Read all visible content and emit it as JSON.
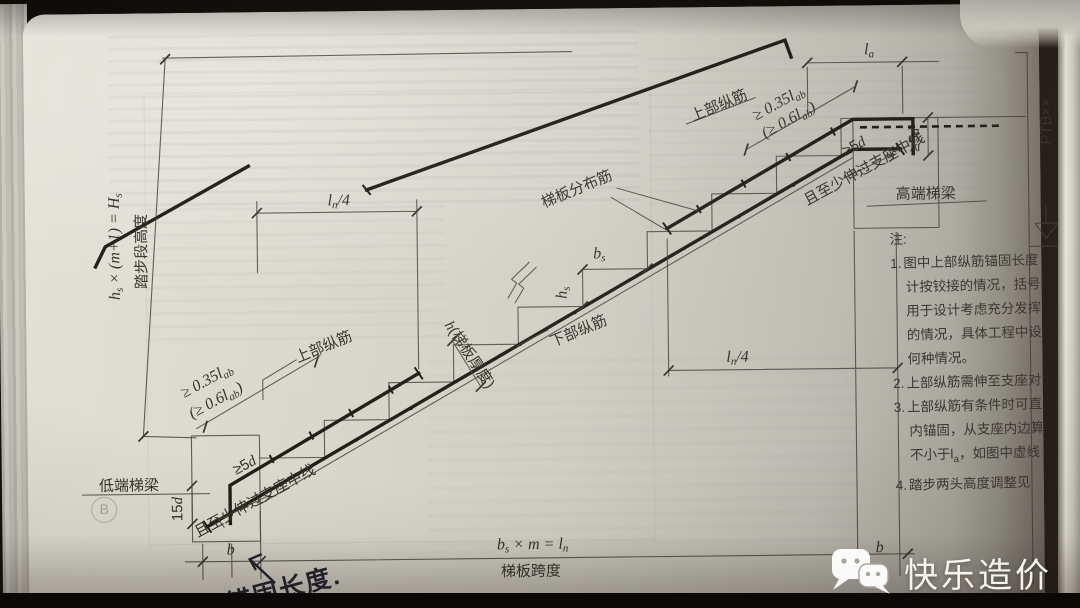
{
  "labels": {
    "flight_formula": {
      "p1": "h",
      "s1": "s",
      "p2": " × (m+1) = H",
      "s2": "s"
    },
    "flight_height": "踏步段高度",
    "ln4": {
      "p1": "l",
      "s1": "n",
      "p2": "/4"
    },
    "la": {
      "p1": "l",
      "s1": "a"
    },
    "anchor_035": {
      "p1": "≥ 0.35l",
      "s1": "ab"
    },
    "anchor_06": {
      "p1": "(≥ 0.6l",
      "s1": "ab",
      "p2": ")"
    },
    "top_bar": "上部纵筋",
    "dist_bar": "梯板分布筋",
    "bottom_bar": "下部纵筋",
    "bs": {
      "p1": "b",
      "s1": "s"
    },
    "hs": {
      "p1": "h",
      "s1": "s"
    },
    "thickness": {
      "p1": "h",
      "p2": "(梯板厚度)"
    },
    "ge5d": {
      "p1": "≥5",
      "p2": "d"
    },
    "d15": {
      "p1": "15",
      "p2": "d"
    },
    "extend_support": "且至少伸过支座中线",
    "low_beam": "低端梯梁",
    "high_beam": "高端梯梁",
    "b": "b",
    "span_formula": {
      "p1": "b",
      "s1": "s",
      "p2": " × m = l",
      "s2": "n"
    },
    "span": "梯板跨度",
    "ptb": "PTB××",
    "circled_b": "B"
  },
  "notes": {
    "title": "注:",
    "n1": "1.",
    "n2": "2.",
    "n3": "3.",
    "n4": "4.",
    "l1a": "图中上部纵筋锚固长度",
    "l1b": "计按铰接的情况，括号",
    "l1c": "用于设计考虑充分发挥",
    "l1d": "的情况，具体工程中设",
    "l1e": "何种情况。",
    "l2a": "上部纵筋需伸至支座对",
    "l3a": "上部纵筋有条件时可直",
    "l3b": "内锚固，从支座内边算",
    "l3c_pre": "不小于l",
    "l3c_sub": "a",
    "l3c_post": "，如图中虚线",
    "l4a": "踏步两头高度调整见"
  },
  "handwriting": {
    "text": "锚固长度."
  },
  "watermark": {
    "brand": "快乐造价",
    "icon": "wechat-icon",
    "color": "#fbf9f4"
  },
  "colors": {
    "paper": "#d6d3c8",
    "ink": "#36322b",
    "rebar": "#211e19",
    "bar": "#0a0908"
  }
}
